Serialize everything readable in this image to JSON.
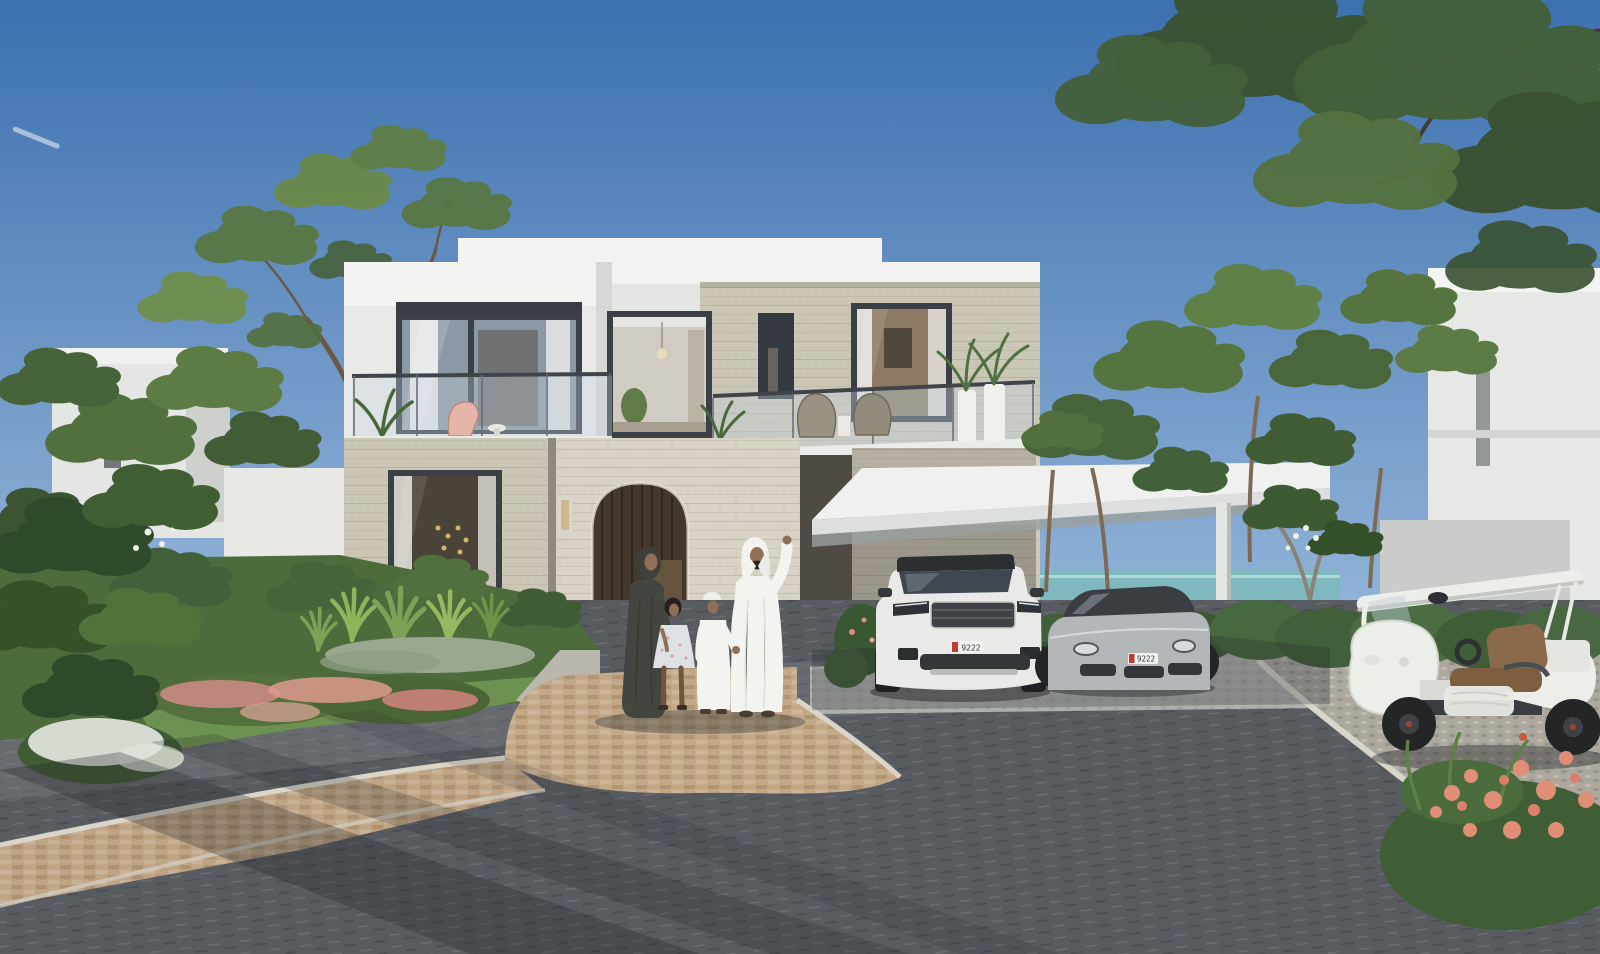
{
  "scene": {
    "description": "Sunny 3D architectural rendering of a modern two-storey stone-and-white villa. An Emirati family of four (father in white kandura waving, mother in dark abaya, daughter in floral dress, son in white kandura) stands by the arched entry. A white luxury SUV and a silver sports sedan are parked under a white carport canopy; a white golf buggy with brown seats stands on a cobbled apron to the right. Landscaped gardens with agaves, pink and white flowers surround a dark paved driveway, with trees overhead, neighbouring white villas and a glimpse of the sea."
  },
  "vehicles": {
    "plate_text": "9222"
  },
  "palette": {
    "sky_top": "#3c70af",
    "sky_horizon": "#93b4d8",
    "sea": "#7fb9bf",
    "fascia_white": "#f3f4f1",
    "white_wall": "#e9eae7",
    "stone_light": "#d8d3c4",
    "stone_mid": "#cbc7b7",
    "stone_shaded": "#a9a496",
    "window_frame": "#3a4045",
    "glass": "#8b98a6",
    "interior_warm": "#8c7a62",
    "arch_wood": "#44382c",
    "canopy_white": "#f0f1ee",
    "road_dark": "#585c61",
    "apron_gray": "#aeb0ab",
    "cobble_light": "#aca89e",
    "walkway_tan": "#c4a988",
    "curb_light": "#d9d5c9",
    "lawn_green": "#6d9150",
    "foliage_dark": "#3b5432",
    "foliage_mid": "#52703e",
    "foliage_light": "#7a9b52",
    "hedge_green": "#44613a",
    "trunk_brown": "#6b5844",
    "flower_pink": "#dd8d7b",
    "flower_white": "#edf0e6",
    "suv_white": "#e9eae7",
    "car_silver": "#b3b7ba",
    "cart_white": "#eceee9",
    "seat_brown": "#8b6a4b",
    "skin_tone": "#8f6f55",
    "abaya_dark": "#43463f",
    "kandura_white": "#f3f3ef",
    "plate_red": "#c03b2e"
  }
}
